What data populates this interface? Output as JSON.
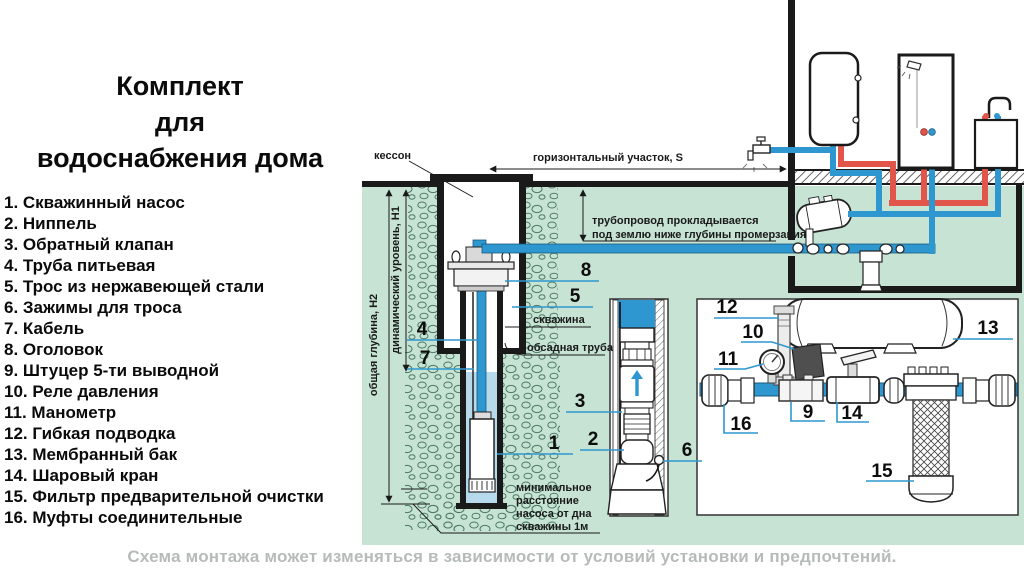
{
  "title": {
    "line1": "Комплект",
    "line2": "для",
    "line3": "водоснабжения дома"
  },
  "parts_list": [
    "1. Скважинный насос",
    "2. Ниппель",
    "3. Обратный клапан",
    "4. Труба питьевая",
    "5. Трос из нержавеющей стали",
    "6. Зажимы для троса",
    "7. Кабель",
    "8. Оголовок",
    "9. Штуцер 5-ти выводной",
    "10. Реле давления",
    "11. Манометр",
    "12. Гибкая подводка",
    "13. Мембранный бак",
    "14. Шаровый кран",
    "15. Фильтр предварительной очистки",
    "16. Муфты соединительные"
  ],
  "caption": "Схема монтажа может изменяться в зависимости от условий установки и предпочтений.",
  "diagram": {
    "annotations": {
      "caisson": "кессон",
      "horizontal_section": "горизонтальный участок, S",
      "pipeline_note_1": "трубопровод прокладывается",
      "pipeline_note_2": "под землю ниже глубины промерзания",
      "total_depth": "общая глубина, Н2",
      "dynamic_level": "динамический уровень, Н1",
      "borehole": "скважина",
      "casing_pipe": "обсадная труба",
      "min_distance_1": "минимальное",
      "min_distance_2": "расстояние",
      "min_distance_3": "насоса от дна",
      "min_distance_4": "скважины 1м"
    },
    "callouts": {
      "n1": "1",
      "n2": "2",
      "n3": "3",
      "n4": "4",
      "n5": "5",
      "n6": "6",
      "n7": "7",
      "n8": "8",
      "n9": "9",
      "n10": "10",
      "n11": "11",
      "n12": "12",
      "n13": "13",
      "n14": "14",
      "n15": "15",
      "n16": "16"
    }
  },
  "colors": {
    "ground_green": "#c7e3d4",
    "pipe_blue": "#2f97cf",
    "pipe_red": "#e2554a",
    "water_blue": "#b7d9ec",
    "line_black": "#1a1a1a",
    "leader_blue": "#2f97cf",
    "caption_gray": "#b6bbba"
  }
}
